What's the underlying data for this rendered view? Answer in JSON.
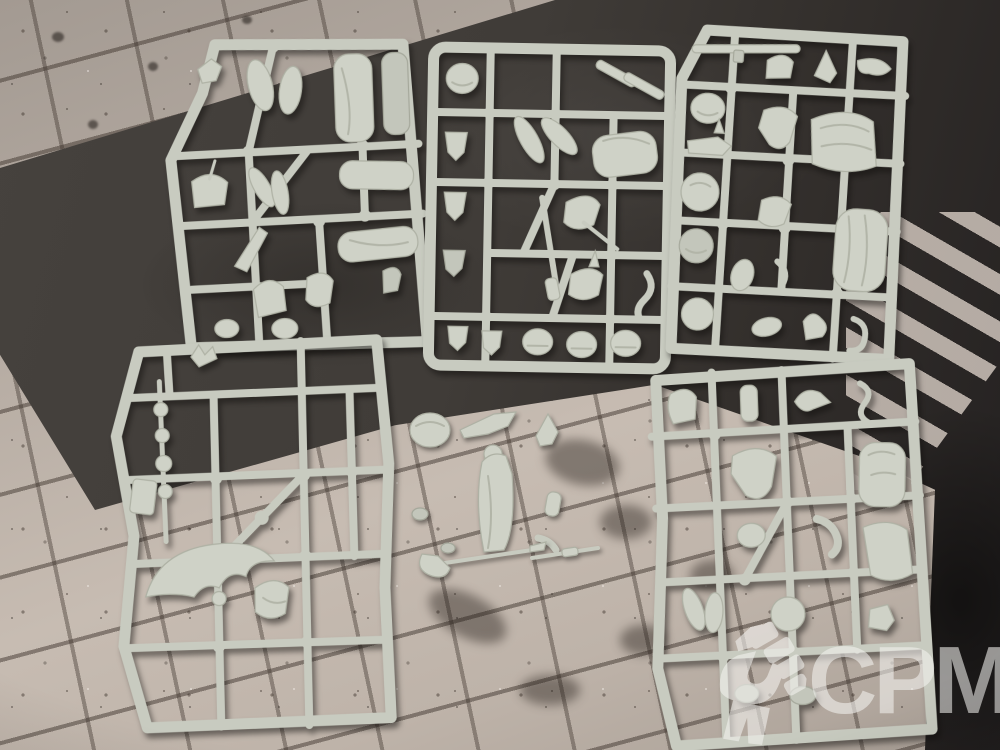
{
  "image": {
    "type": "photograph",
    "subject": "Top-down photo of five light grey plastic model sprues with unassembled miniature parts, laid out on a grey cobblestone and asphalt road gaming mat",
    "objects": [
      "sprue-top-left",
      "sprue-top-middle",
      "sprue-top-right",
      "sprue-bottom-left",
      "sprue-bottom-right",
      "loose-parts-cluster",
      "loose-weapon-parts",
      "crosswalk-road-marking"
    ]
  },
  "watermark": {
    "brand": "CPM",
    "icon": "raised-fist-icon"
  },
  "colors": {
    "sprue_plastic": "#c9ccc1",
    "mat_stone_light": "#c7bcb2",
    "mat_stone_shadow": "#a39a92",
    "mat_grout": "#4a423c",
    "asphalt": "#403c38",
    "dark_edge": "#232020",
    "crosswalk_stripe": "#d6cbc2",
    "watermark_white": "#f4f3f0"
  },
  "counts": {
    "sprues": 5,
    "loose_part_clusters": 2
  }
}
